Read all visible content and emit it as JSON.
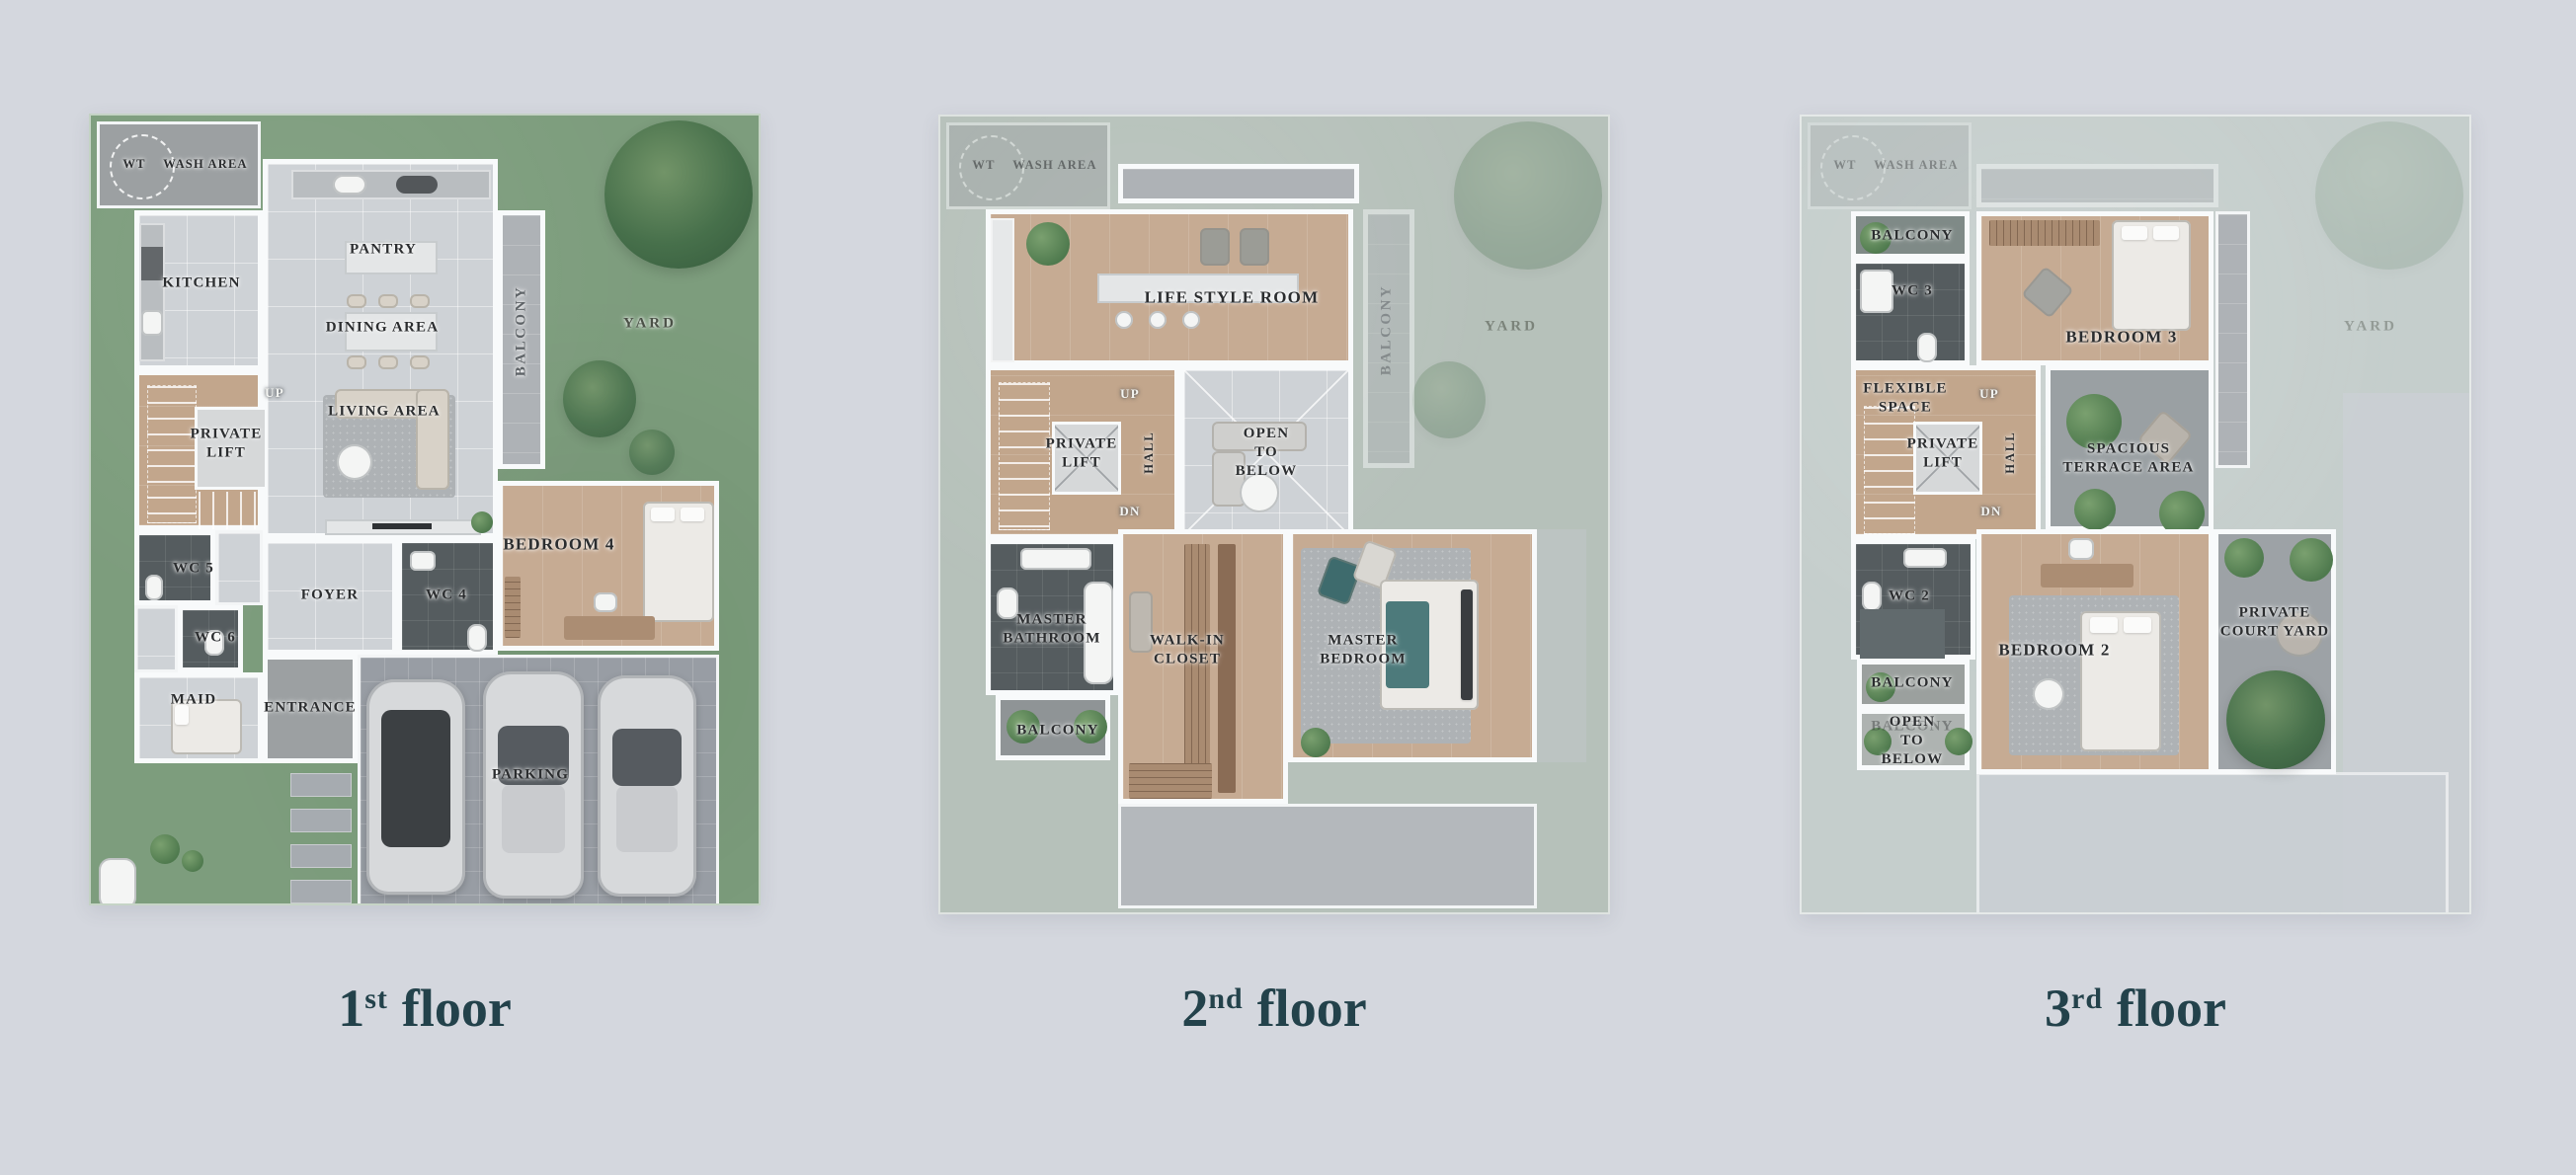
{
  "palette": {
    "background": "#d4d7de",
    "caption_text": "#23424b",
    "grass": "#7d9d7d",
    "grass_faded": "#b6c1ba",
    "grass_faint": "#c5cecc",
    "wood": "#c6ab93",
    "tile": "#ced2d6",
    "concrete": "#9ca0a2",
    "dark_tile": "#555c5f",
    "wall": "#f8fafb"
  },
  "captions": {
    "f1": {
      "num": "1",
      "sup": "st",
      "word": "floor"
    },
    "f2": {
      "num": "2",
      "sup": "nd",
      "word": "floor"
    },
    "f3": {
      "num": "3",
      "sup": "rd",
      "word": "floor"
    }
  },
  "floors": {
    "f1": {
      "wt": "WT",
      "wash": "WASH AREA",
      "kitchen": "KITCHEN",
      "pantry": "PANTRY",
      "dining": "DINING AREA",
      "living": "LIVING AREA",
      "balcony": "BALCONY",
      "yard": "YARD",
      "up": "UP",
      "lift": "PRIVATE\nLIFT",
      "wc5": "WC 5",
      "wc6": "WC 6",
      "maid": "MAID",
      "foyer": "FOYER",
      "wc4": "WC 4",
      "bedroom4": "BEDROOM 4",
      "entrance": "ENTRANCE",
      "parking": "PARKING"
    },
    "f2": {
      "wt": "WT",
      "wash": "WASH AREA",
      "lifestyle": "LIFE STYLE ROOM",
      "balcony": "BALCONY",
      "yard": "YARD",
      "up": "UP",
      "dn": "DN",
      "lift": "PRIVATE\nLIFT",
      "hall": "HALL",
      "open": "OPEN\nTO\nBELOW",
      "mbath": "MASTER\nBATHROOM",
      "balcony2": "BALCONY",
      "closet": "WALK-IN\nCLOSET",
      "mbed": "MASTER\nBEDROOM"
    },
    "f3": {
      "wt": "WT",
      "wash": "WASH AREA",
      "balcony_top": "BALCONY",
      "wc3": "WC 3",
      "bedroom3": "BEDROOM 3",
      "flexible": "FLEXIBLE\nSPACE",
      "up": "UP",
      "dn": "DN",
      "lift": "PRIVATE\nLIFT",
      "hall": "HALL",
      "terrace": "SPACIOUS\nTERRACE AREA",
      "yard": "YARD",
      "wc2": "WC 2",
      "balcony_mid": "BALCONY",
      "balcony_ghost": "BALCONY",
      "open": "OPEN\nTO\nBELOW",
      "bedroom2": "BEDROOM 2",
      "courtyard": "PRIVATE\nCOURT YARD"
    }
  }
}
